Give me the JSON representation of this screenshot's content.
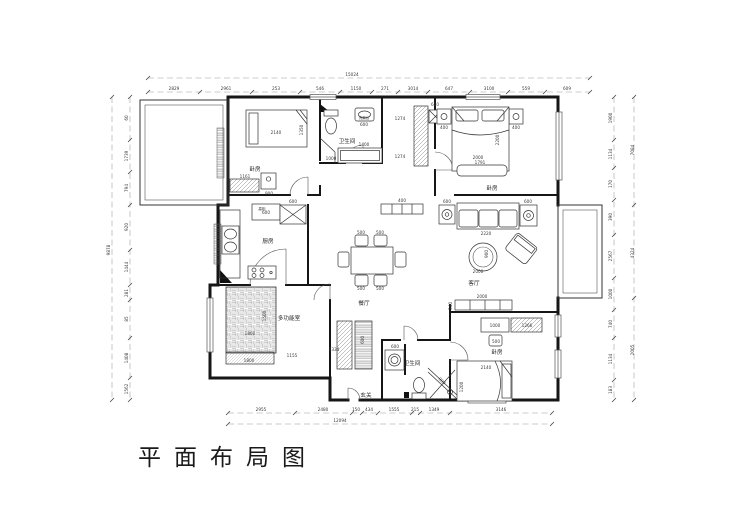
{
  "title": "平面布局图",
  "rooms": {
    "bedroom_tl": "卧房",
    "bathroom_top": "卫生间",
    "washstand": "洗漱台",
    "bedroom_tr": "卧房",
    "kitchen": "厨房",
    "tall_cabinet": "高柜",
    "dining": "餐厅",
    "living": "客厅",
    "multi_room": "多功能室",
    "entry": "玄关",
    "bathroom_bottom": "卫生间",
    "bedroom_br": "卧房"
  },
  "dims": {
    "top_total": "15024",
    "top": [
      "2829",
      "2961",
      "253",
      "546",
      "1150",
      "271",
      "3014",
      "647",
      "3100",
      "559",
      "609"
    ],
    "bottom_total": "12094",
    "bottom": [
      "2955",
      "2480",
      "150",
      "434",
      "1555",
      "215",
      "1349",
      "3146"
    ],
    "left_total": "9878",
    "left": [
      "60",
      "1739",
      "794",
      "920",
      "1444",
      "281",
      "85",
      "1408",
      "1562"
    ],
    "right": [
      "1900",
      "1134",
      "170",
      "390",
      "2567",
      "1000",
      "740",
      "1134",
      "183"
    ],
    "right_outer": [
      "7084",
      "4324",
      "2005"
    ],
    "furniture": {
      "bed_tl_w": "2140",
      "bed_tl_h": "1350",
      "dresser_tl": "900",
      "wardrobe_tl": "1161",
      "bath_top_a": "1000",
      "bath_top_b": "1400",
      "basin_top": "600",
      "closet_a": "1274",
      "closet_b": "1274",
      "closet_c": "600",
      "nightstand": "400",
      "bed_tr_w": "2000",
      "bed_tr_h": "2200",
      "bench_tr": "1791",
      "endtable": "600",
      "sofa_w": "2220",
      "rug_d": "900",
      "rug_w": "2000",
      "tv_w": "2000",
      "tv_d": "340",
      "chair": "500",
      "sideboard": "400",
      "fridge": "600",
      "kcab": "600",
      "tatami_w": "1800",
      "tatami_h": "1500",
      "desk_multi": "1800",
      "multi_a": "1155",
      "multi_b": "1334",
      "strip_b": "600",
      "washer": "600",
      "shower": "900",
      "desk_br": "1000",
      "chair_br": "500",
      "wardrobe_br": "1266",
      "bed_br_w": "2140",
      "bed_br_h": "1200"
    }
  }
}
